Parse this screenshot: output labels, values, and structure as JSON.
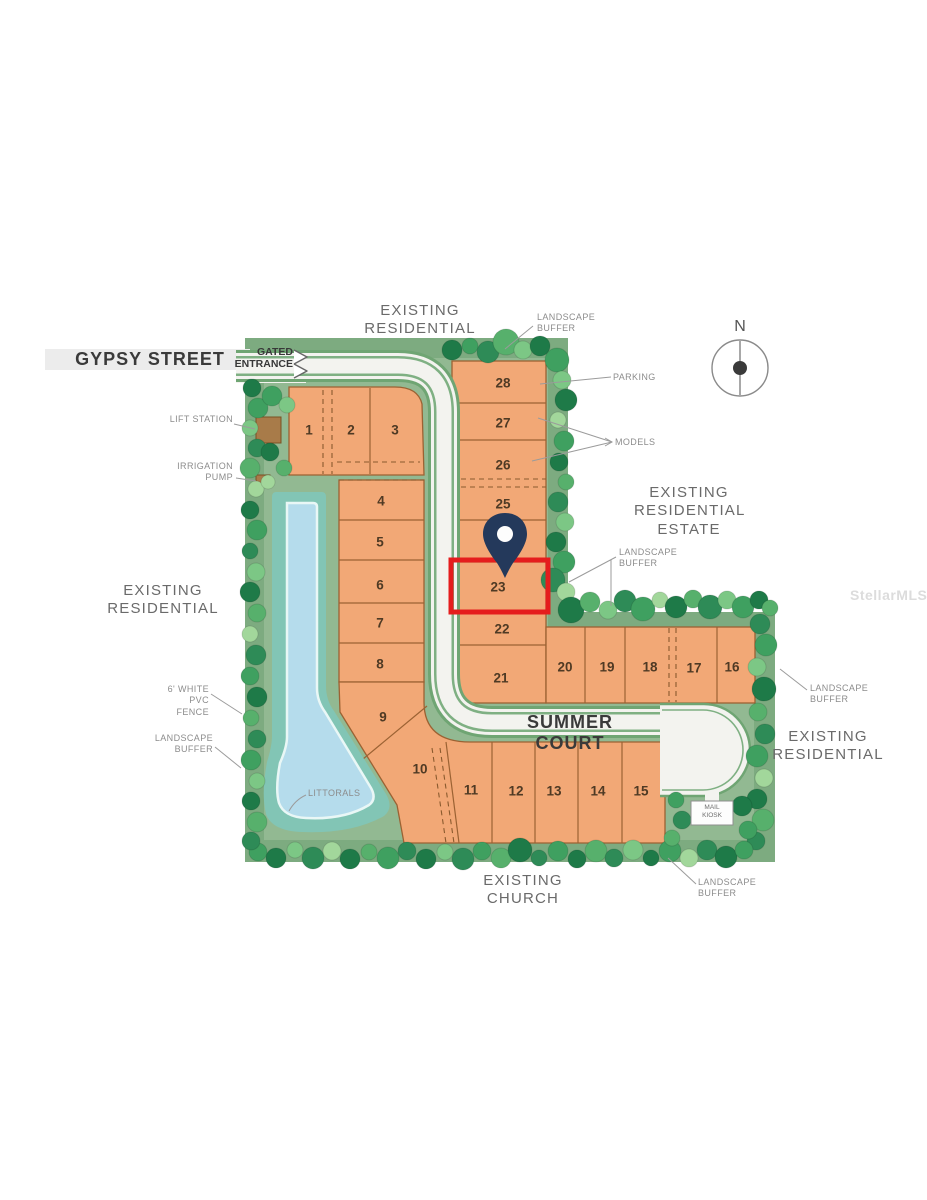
{
  "streets": {
    "gypsy": "GYPSY STREET",
    "summer": "SUMMER COURT"
  },
  "entrance": {
    "label": "GATED ENTRANCE"
  },
  "areas": {
    "top": "EXISTING RESIDENTIAL",
    "estate": "EXISTING RESIDENTIAL ESTATE",
    "left": "EXISTING RESIDENTIAL",
    "right": "EXISTING RESIDENTIAL",
    "church": "EXISTING CHURCH"
  },
  "callouts": {
    "landscape_buffer_top": "LANDSCAPE BUFFER",
    "parking": "PARKING",
    "models": "MODELS",
    "lift_station": "LIFT STATION",
    "irrigation_pump": "IRRIGATION PUMP",
    "landscape_buffer_mid": "LANDSCAPE BUFFER",
    "pvc_fence": "6' WHITE PVC FENCE",
    "landscape_buffer_left": "LANDSCAPE BUFFER",
    "littorals": "LITTORALS",
    "landscape_buffer_right": "LANDSCAPE BUFFER",
    "landscape_buffer_bottom": "LANDSCAPE BUFFER",
    "mail_kiosk": "MAIL KIOSK"
  },
  "compass": {
    "label": "N"
  },
  "watermark": "StellarMLS",
  "highlight": {
    "lot": "23",
    "box_color": "#e51d1d",
    "pin_color": "#24395b"
  },
  "lots": {
    "lot1": "1",
    "lot2": "2",
    "lot3": "3",
    "lot4": "4",
    "lot5": "5",
    "lot6": "6",
    "lot7": "7",
    "lot8": "8",
    "lot9": "9",
    "lot10": "10",
    "lot11": "11",
    "lot12": "12",
    "lot13": "13",
    "lot14": "14",
    "lot15": "15",
    "lot16": "16",
    "lot17": "17",
    "lot18": "18",
    "lot19": "19",
    "lot20": "20",
    "lot21": "21",
    "lot22": "22",
    "lot23": "23",
    "lot25": "25",
    "lot26": "26",
    "lot27": "27",
    "lot28": "28"
  },
  "colors": {
    "lot_fill": "#f2a876",
    "lot_line": "#9b6233",
    "site_green": "#92b992",
    "buffer_green": "#7dab80",
    "road": "#f3f3ef",
    "road_edge": "#6fa573",
    "pond_outer": "#82c5b5",
    "pond_inner": "#b5dcec",
    "highlight_red": "#e51d1d",
    "pin_navy": "#24395b"
  }
}
